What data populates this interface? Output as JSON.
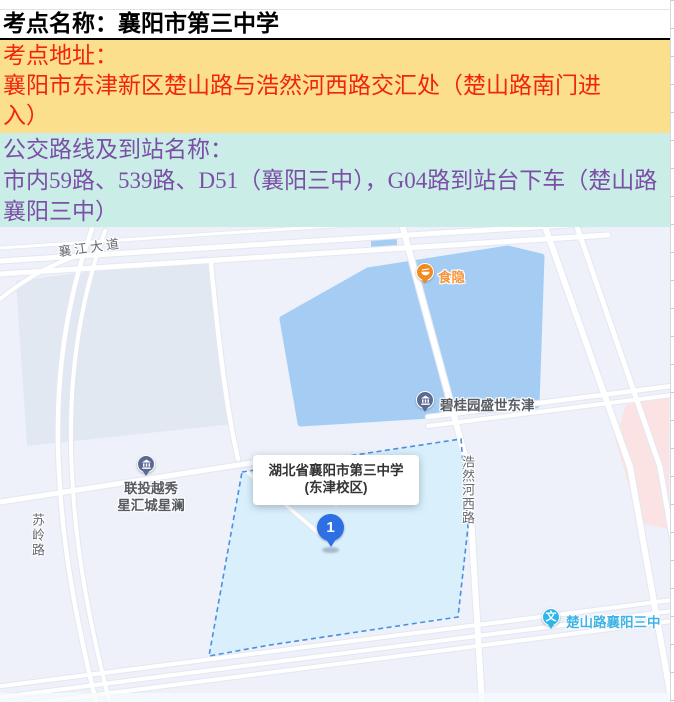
{
  "sections": {
    "title": "考点名称：襄阳市第三中学",
    "address": {
      "label": "考点地址：",
      "value": "襄阳市东津新区楚山路与浩然河西路交汇处（楚山路南门进入）"
    },
    "bus": {
      "label": "公交路线及到站名称：",
      "value": "市内59路、539路、D51（襄阳三中），G04路到站台下车（楚山路襄阳三中）"
    }
  },
  "map": {
    "road_labels": {
      "xiangjiang_avenue": "襄江大道",
      "suling_road": "苏岭路",
      "haoranhexi_road": "浩然河西路"
    },
    "pois": {
      "shiyin": "食隐",
      "biguiyuan_shengshi_dongjin": "碧桂园盛世东津",
      "liantou_yuexiu_line1": "联投越秀",
      "liantou_yuexiu_line2": "星汇城星澜",
      "bus_stop_chushanlu": "楚山路襄阳三中",
      "bus_stop_icon_glyph": "文"
    },
    "school_info_window": {
      "line1": "湖北省襄阳市第三中学",
      "line2": "(东津校区)"
    },
    "marker_label": "1"
  },
  "colors": {
    "title_text": "#000000",
    "address_bg": "#FBDF8D",
    "address_text": "#F0240F",
    "bus_bg": "#CBEDE7",
    "bus_text": "#7B4FA6",
    "map_background": "#EEF1F9",
    "map_water": "#A5CDF3",
    "school_area_fill": "#D9EFFC",
    "school_area_border": "#4A8FE0",
    "marker_blue": "#2F6FE4",
    "poi_pin_gray_blue": "#5B6A92",
    "poi_orange": "#F28B1F",
    "bus_stop_cyan": "#2EB6E8"
  }
}
